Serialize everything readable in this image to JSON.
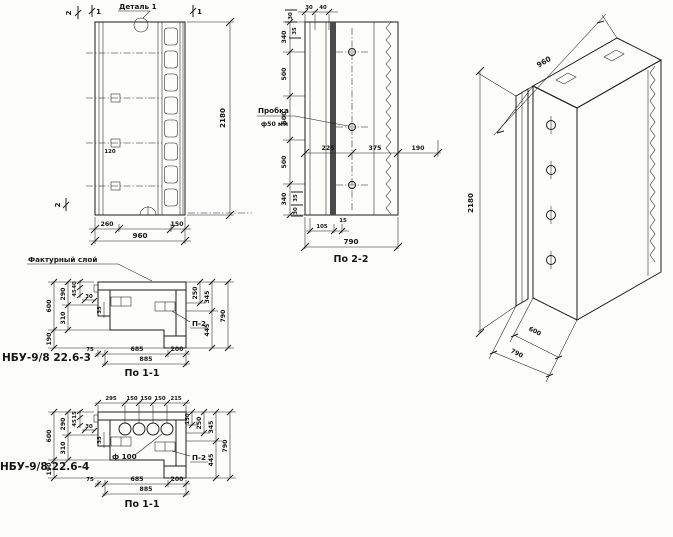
{
  "drawing": {
    "front_view": {
      "detail_label": "Деталь 1",
      "section_mark_1": "1",
      "section_mark_2": "2",
      "dim_anchor_spacing": "120",
      "dim_left_part": "260",
      "dim_right_part": "150",
      "dim_width": "960",
      "dim_height": "2180"
    },
    "section_2_2": {
      "title": "По 2-2",
      "plug_label": "Пробка",
      "plug_diameter": "ф50 мм",
      "dim_top_30": "30",
      "dim_top_40": "40",
      "dim_left_30": "30",
      "dim_left_35": "35",
      "height_chain": [
        "340",
        "500",
        "500",
        "500",
        "340"
      ],
      "dim_225": "225",
      "dim_375": "375",
      "dim_190": "190",
      "dim_bottom_35": "35",
      "dim_bottom_30": "30",
      "dim_bottom_105": "105",
      "dim_bottom_15": "15",
      "dim_width": "790"
    },
    "isometric": {
      "dim_width": "960",
      "dim_height": "2180",
      "dim_depth_main": "600",
      "dim_depth_total": "790"
    },
    "section_1_1_a": {
      "title": "По 1-1",
      "code": "НБУ-9/8 22.6-3",
      "texture_label": "Фактурный слой",
      "plate_label": "П-2",
      "dim_290": "290",
      "dim_310": "310",
      "dim_600": "600",
      "dim_190": "190",
      "mini": [
        "40",
        "45",
        "30",
        "35"
      ],
      "dim_250": "250",
      "dim_345": "345",
      "dim_445": "445",
      "dim_790": "790",
      "dim_75": "75",
      "dim_685": "685",
      "dim_200": "200",
      "dim_885": "885"
    },
    "section_1_1_b": {
      "title": "По 1-1",
      "code": "НБУ-9/8.22.6-4",
      "plate_label": "П-2",
      "hole_label": "ф 100",
      "top_chain": [
        "295",
        "150",
        "150",
        "150",
        "215"
      ],
      "dim_150": "150",
      "dim_290": "290",
      "dim_310": "310",
      "dim_600": "600",
      "dim_190": "190",
      "mini": [
        "15",
        "45",
        "30",
        "35"
      ],
      "dim_250": "250",
      "dim_345": "345",
      "dim_445": "445",
      "dim_790": "790",
      "dim_75": "75",
      "dim_685": "685",
      "dim_200": "200",
      "dim_885": "885"
    }
  }
}
